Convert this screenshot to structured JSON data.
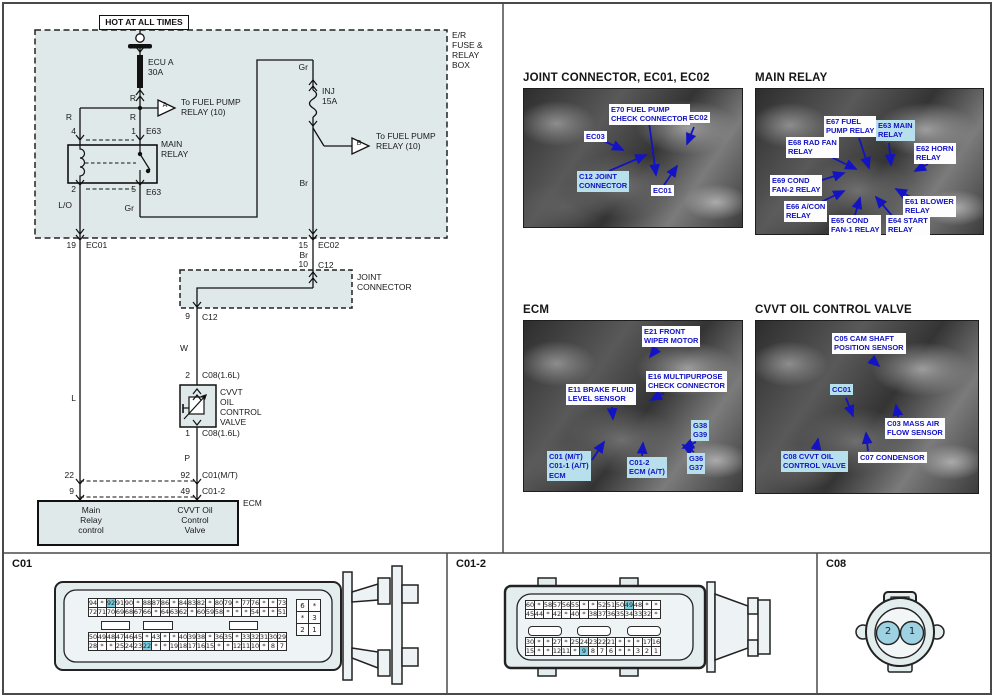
{
  "circuit": {
    "hot": "HOT AT ALL TIMES",
    "er_box": "E/R\nFUSE &\nRELAY\nBOX",
    "fuse_a": "ECU A\n30A",
    "r_top": "R",
    "r_left": "R",
    "r_right": "R",
    "tri_a_letter": "A",
    "tri_a_text": "To FUEL PUMP\nRELAY (10)",
    "pin4": "4",
    "pin1": "1",
    "e63_top": "E63",
    "main_relay": "MAIN\nRELAY",
    "pin2": "2",
    "pin5": "5",
    "e63_bottom": "E63",
    "lo": "L/O",
    "gr_bottom": "Gr",
    "gr_top": "Gr",
    "fuse_b": "INJ\n15A",
    "tri_b_letter": "B",
    "tri_b_text": "To FUEL PUMP\nRELAY (10)",
    "br_top": "Br",
    "pin19": "19",
    "ec01": "EC01",
    "pin15": "15",
    "ec02": "EC02",
    "br_mid": "Br",
    "pin10": "10",
    "c12_top": "C12",
    "joint_connector": "JOINT\nCONNECTOR",
    "pin9_c12": "9",
    "c12_bottom": "C12",
    "w": "W",
    "pin2_c08": "2",
    "c08_top": "C08(1.6L)",
    "cvvt_valve": "CVVT\nOIL\nCONTROL\nVALVE",
    "pin1_c08": "1",
    "c08_bottom": "C08(1.6L)",
    "p": "P",
    "l": "L",
    "pin22": "22",
    "pin9": "9",
    "pin92": "92",
    "c01mt": "C01(M/T)",
    "pin49": "49",
    "c01_2": "C01-2",
    "ecm": "ECM",
    "ecm_main_relay": "Main\nRelay\ncontrol",
    "ecm_cvvt": "CVVT Oil\nControl\nValve"
  },
  "photos": {
    "p1": {
      "title": "JOINT CONNECTOR, EC01, EC02",
      "callouts": [
        {
          "text": "E70 FUEL PUMP\nCHECK CONNECTOR",
          "hl": false
        },
        {
          "text": "EC03",
          "hl": false
        },
        {
          "text": "C12 JOINT\nCONNECTOR",
          "hl": true
        },
        {
          "text": "EC02",
          "hl": false
        },
        {
          "text": "EC01",
          "hl": false
        }
      ]
    },
    "p2": {
      "title": "MAIN RELAY",
      "callouts": [
        {
          "text": "E67 FUEL\nPUMP RELAY",
          "hl": false
        },
        {
          "text": "E63 MAIN\nRELAY",
          "hl": true
        },
        {
          "text": "E68 RAD FAN\nRELAY",
          "hl": false
        },
        {
          "text": "E62 HORN\nRELAY",
          "hl": false
        },
        {
          "text": "E69 COND\nFAN-2 RELAY",
          "hl": false
        },
        {
          "text": "E66 A/CON\nRELAY",
          "hl": false
        },
        {
          "text": "E65 COND\nFAN-1 RELAY",
          "hl": false
        },
        {
          "text": "E64 START\nRELAY",
          "hl": false
        },
        {
          "text": "E61 BLOWER\nRELAY",
          "hl": false
        }
      ]
    },
    "p3": {
      "title": "ECM",
      "callouts": [
        {
          "text": "E21 FRONT\nWIPER MOTOR",
          "hl": false
        },
        {
          "text": "E16 MULTIPURPOSE\nCHECK CONNECTOR",
          "hl": false
        },
        {
          "text": "E11 BRAKE FLUID\nLEVEL SENSOR",
          "hl": false
        },
        {
          "text": "G38\nG39",
          "hl": true
        },
        {
          "text": "C01 (M/T)\nC01-1 (A/T)\nECM",
          "hl": true
        },
        {
          "text": "C01-2\nECM (A/T)",
          "hl": true
        },
        {
          "text": "G36\nG37",
          "hl": true
        }
      ]
    },
    "p4": {
      "title": "CVVT OIL CONTROL VALVE",
      "callouts": [
        {
          "text": "C05 CAM SHAFT\nPOSITION SENSOR",
          "hl": false
        },
        {
          "text": "CC01",
          "hl": true
        },
        {
          "text": "C03 MASS AIR\nFLOW SENSOR",
          "hl": false
        },
        {
          "text": "C08 CVVT OIL\nCONTROL VALVE",
          "hl": true
        },
        {
          "text": "C07 CONDENSOR",
          "hl": false
        }
      ]
    }
  },
  "connectors": {
    "c01": {
      "label": "C01",
      "top": {
        "rows": [
          [
            "94",
            "*",
            "92",
            "91",
            "90",
            "*",
            "88",
            "87",
            "86",
            "*",
            "84",
            "83",
            "82",
            "*",
            "80",
            "79",
            "*",
            "77",
            "76",
            "*",
            "*",
            "73"
          ],
          [
            "72",
            "71",
            "70",
            "69",
            "68",
            "67",
            "66",
            "*",
            "64",
            "63",
            "62",
            "*",
            "60",
            "59",
            "58",
            "*",
            "*",
            "*",
            "54",
            "*",
            "*",
            "51"
          ]
        ],
        "highlights": [
          "92"
        ]
      },
      "bottom": {
        "rows": [
          [
            "50",
            "49",
            "48",
            "47",
            "46",
            "45",
            "*",
            "43",
            "*",
            "*",
            "40",
            "39",
            "38",
            "*",
            "36",
            "35",
            "*",
            "33",
            "32",
            "31",
            "30",
            "29"
          ],
          [
            "28",
            "*",
            "*",
            "25",
            "24",
            "23",
            "22",
            "*",
            "*",
            "19",
            "18",
            "17",
            "16",
            "15",
            "*",
            "*",
            "12",
            "11",
            "10",
            "*",
            "8",
            "7"
          ]
        ],
        "highlights": [
          "22"
        ]
      },
      "side": {
        "rows": [
          [
            "6",
            "*"
          ],
          [
            "*",
            "3"
          ],
          [
            "2",
            "1"
          ]
        ],
        "highlights": []
      }
    },
    "c01_2": {
      "label": "C01-2",
      "top": {
        "rows": [
          [
            "60",
            "*",
            "58",
            "57",
            "56",
            "55",
            "*",
            "*",
            "52",
            "51",
            "50",
            "49",
            "48",
            "*",
            "*"
          ],
          [
            "45",
            "44",
            "*",
            "42",
            "*",
            "40",
            "*",
            "38",
            "37",
            "36",
            "35",
            "34",
            "33",
            "32",
            "*"
          ]
        ],
        "highlights": [
          "49"
        ]
      },
      "bottom": {
        "rows": [
          [
            "30",
            "*",
            "*",
            "27",
            "*",
            "25",
            "24",
            "23",
            "22",
            "21",
            "*",
            "*",
            "*",
            "17",
            "16"
          ],
          [
            "15",
            "*",
            "*",
            "12",
            "11",
            "*",
            "9",
            "8",
            "7",
            "6",
            "*",
            "*",
            "3",
            "2",
            "1"
          ]
        ],
        "highlights": [
          "9"
        ]
      }
    },
    "c08": {
      "label": "C08",
      "pins": [
        "2",
        "1"
      ]
    }
  }
}
